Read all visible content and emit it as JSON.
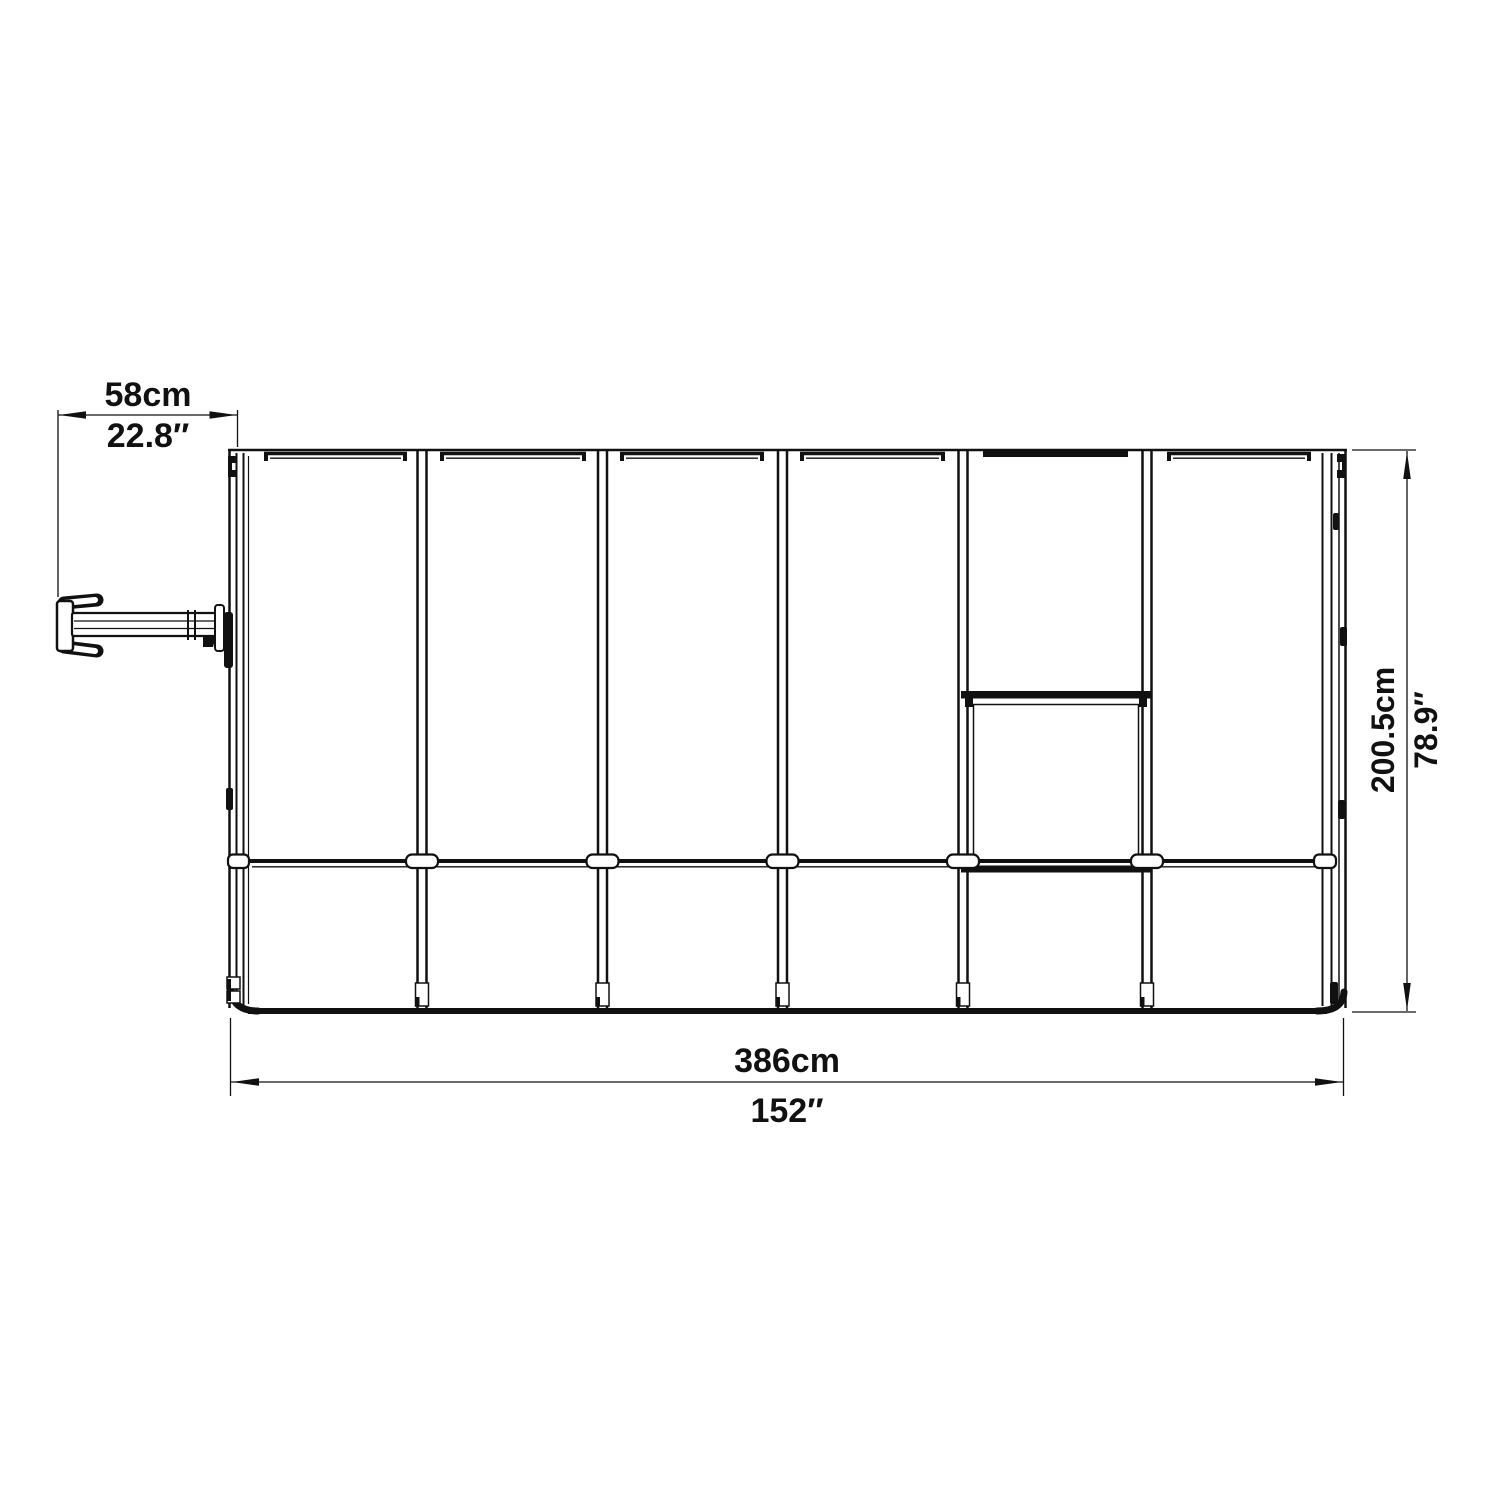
{
  "figure": {
    "type": "technical-drawing",
    "subject": "greenhouse-side-elevation-with-dimensions",
    "colors": {
      "line": "#111111",
      "background": "#ffffff"
    },
    "dimensions": {
      "top": {
        "metric": "58cm",
        "imperial": "22.8″"
      },
      "right": {
        "metric": "200.5cm",
        "imperial": "78.9″"
      },
      "bottom": {
        "metric": "386cm",
        "imperial": "152″"
      }
    }
  }
}
